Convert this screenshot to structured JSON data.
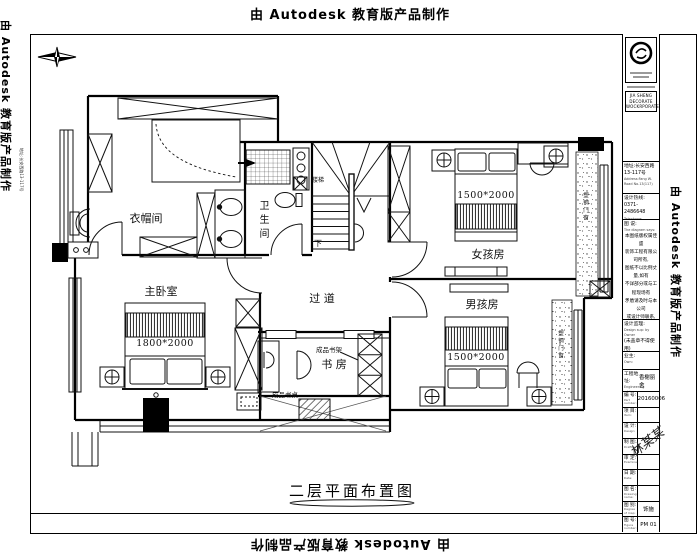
{
  "watermark": {
    "text": "由 Autodesk 教育版产品制作"
  },
  "plan": {
    "rooms": {
      "cloakroom": "衣帽间",
      "bathroom": "卫生间",
      "master_bedroom": "主卧室",
      "corridor": "过 道",
      "study": "书 房",
      "girls_room": "女孩房",
      "boys_room": "男孩房"
    },
    "beds": {
      "master": "1800*2000",
      "girl": "1500*2000",
      "boy": "1500*2000"
    },
    "stairs": {
      "down": "下",
      "label": "楼梯"
    },
    "annotations": {
      "bookshelf": "成品书架",
      "desk": "成品书桌",
      "window_girl": "塑钢门窗",
      "window_boy": "塑钢门窗"
    },
    "caption": "二层平面布置图"
  },
  "titleblock": {
    "company_en_1": "JIA SHENG DECORATE",
    "company_en_2": "WOCKRPORATERKS",
    "address_cn": "地址:长安西路13-117号",
    "address_en": "Address:Fang W. Road No.13(117)",
    "phone_cn": "设计热线: 0371-2486648",
    "phone_en": "Telephone:",
    "diagram_label": "图 说:",
    "diagram_en": "The diagram says:",
    "notice_lines": [
      "本图纸版权属佳盛",
      "装饰工程有限公司所有,",
      "图纸不以比例丈量,如有",
      "不详部分或与工程现场有",
      "矛盾请及时与本公司",
      "或设计师联系, 否则",
      "将承担所有后果."
    ],
    "supervisor_label": "设计监理:",
    "supervisor_en": "Design sup: by Owner",
    "stamp_note": "(未盖章不得使用)",
    "stamp_note_en": "(Not valid without seal)",
    "owner_label": "业主:",
    "owner_en": "Own:",
    "site_label": "工程地址:",
    "site_en": "Engineering address:",
    "site_value": "香榭丽舍",
    "rows": [
      {
        "label": "编 号:",
        "en": "Part number:",
        "value": "20160006"
      },
      {
        "label": "项 目:",
        "en": "Item:",
        "value": ""
      },
      {
        "label": "设 计:",
        "en": "Design:",
        "value": ""
      },
      {
        "label": "制 图:",
        "en": "Drafting:",
        "value": ""
      },
      {
        "label": "审 定:",
        "en": "Examine:",
        "value": ""
      },
      {
        "label": "日 期:",
        "en": "Date:",
        "value": ""
      },
      {
        "label": "图 名:",
        "en": "Drawing name:",
        "value": ""
      },
      {
        "label": "图 别:",
        "en": "Degree of map:",
        "value": "饰施"
      },
      {
        "label": "图 号:",
        "en": "Figure number:",
        "value": "PM 01"
      }
    ],
    "signature": "林某某"
  }
}
